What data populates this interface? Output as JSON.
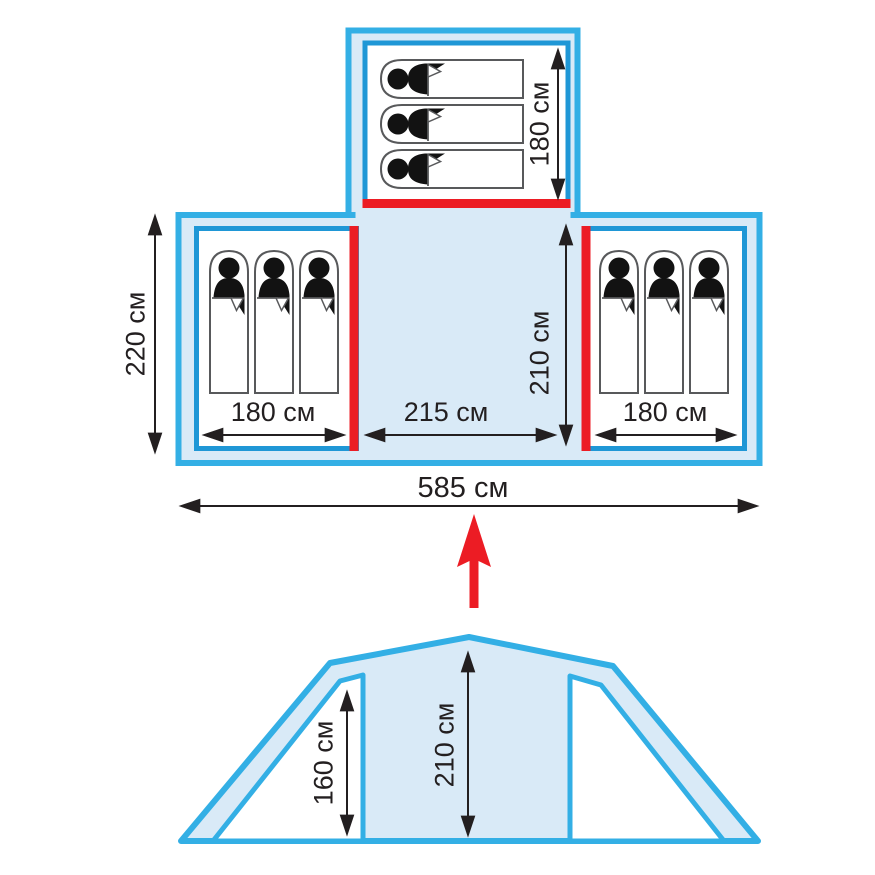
{
  "title": "Tent floor plan and front elevation diagram",
  "colors": {
    "outline_cyan": "#33AFE5",
    "inner_blue": "#1F97D6",
    "fill_light": "#D9EAF7",
    "door_red": "#EC1C24",
    "text_dark": "#231F20",
    "bag_gray": "#58595B",
    "bag_black": "#121212"
  },
  "floor_plan": {
    "top_room": {
      "sleeping_bags": 3,
      "length_label": "180 см"
    },
    "left_room": {
      "sleeping_bags": 3,
      "width_label": "180 см"
    },
    "right_room": {
      "sleeping_bags": 3,
      "width_label": "180 см"
    },
    "center": {
      "width_label": "215 см",
      "depth_label": "210 см"
    },
    "overall": {
      "depth_label": "220 см",
      "total_width_label": "585 см"
    }
  },
  "elevation": {
    "side_height_label": "160 см",
    "center_height_label": "210 см"
  }
}
